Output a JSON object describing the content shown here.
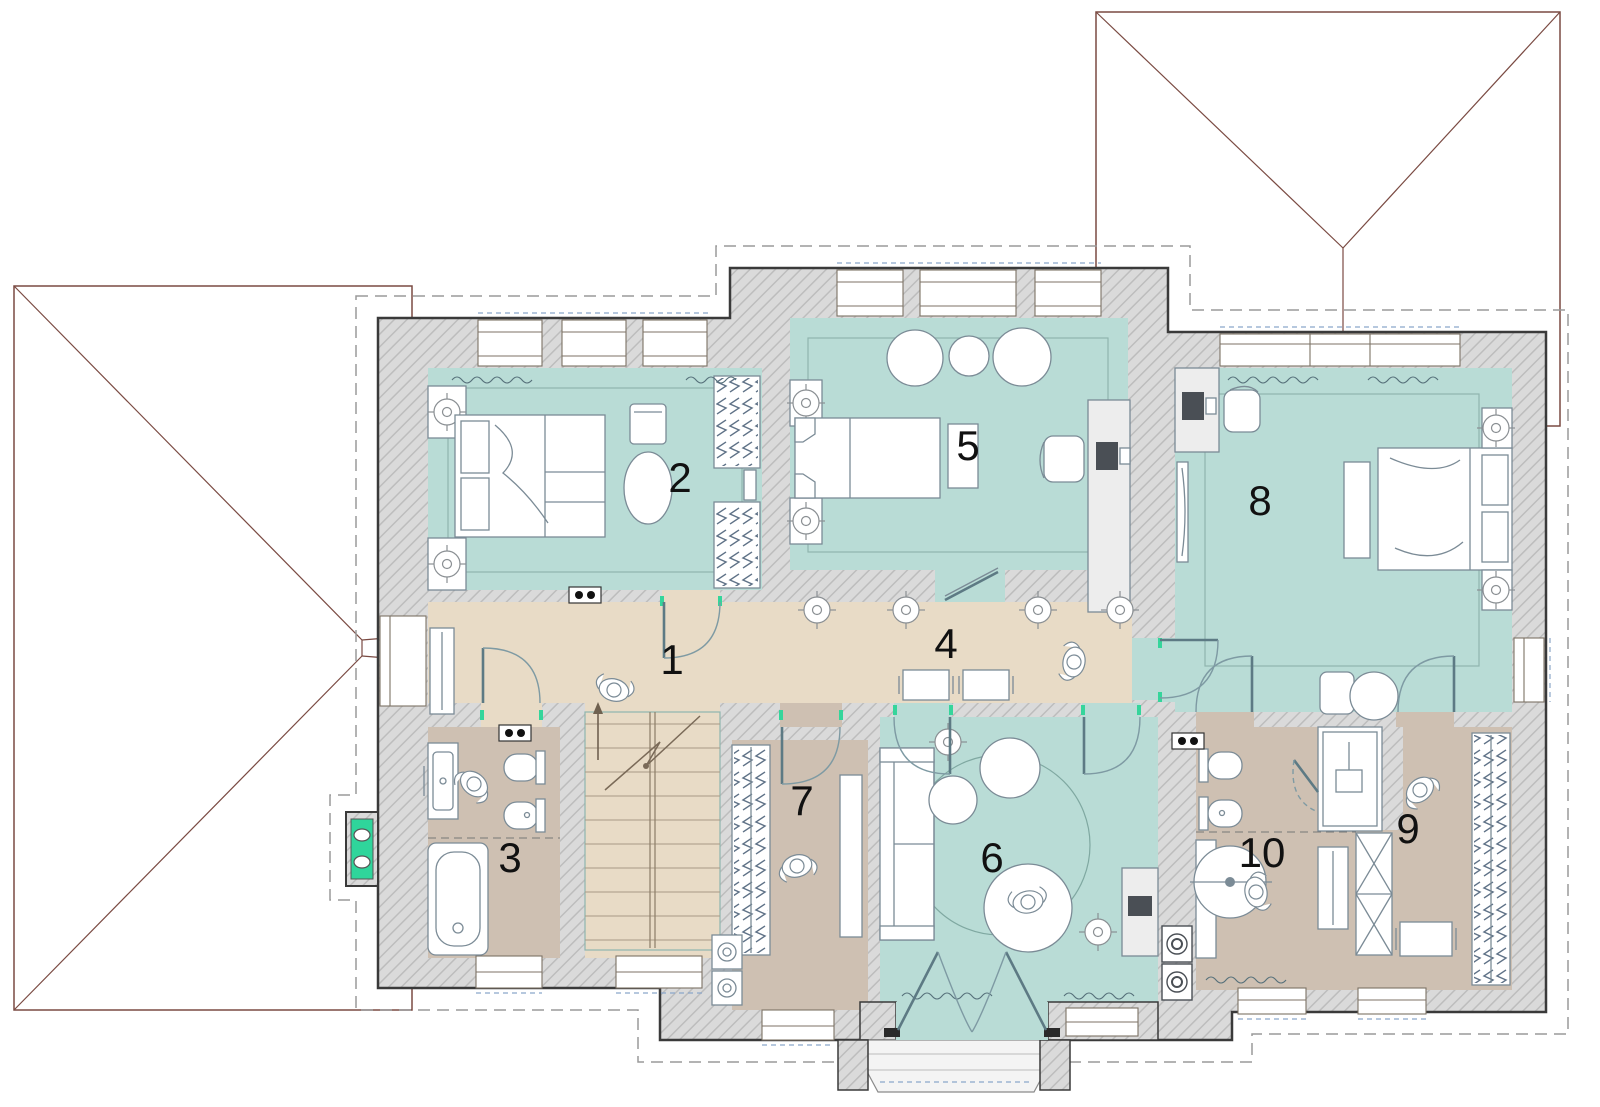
{
  "plan": {
    "rooms": [
      {
        "number": "1"
      },
      {
        "number": "2"
      },
      {
        "number": "3"
      },
      {
        "number": "4"
      },
      {
        "number": "5"
      },
      {
        "number": "6"
      },
      {
        "number": "7"
      },
      {
        "number": "8"
      },
      {
        "number": "9"
      },
      {
        "number": "10"
      }
    ],
    "colors": {
      "teal": "#b9dcd6",
      "beige": "#e8dbc6",
      "taupe": "#cec0b2",
      "wall_fill": "#dadada",
      "wall_hatch": "#bdbdbd",
      "outline": "#3a3a3a",
      "roof_line": "#7a4a42",
      "eaves_dash": "#9a9a9a",
      "accent_green": "#2fd59b",
      "furniture_line": "#7b8b96",
      "label": "#111111",
      "window_blue": "#8ba6c9"
    }
  }
}
